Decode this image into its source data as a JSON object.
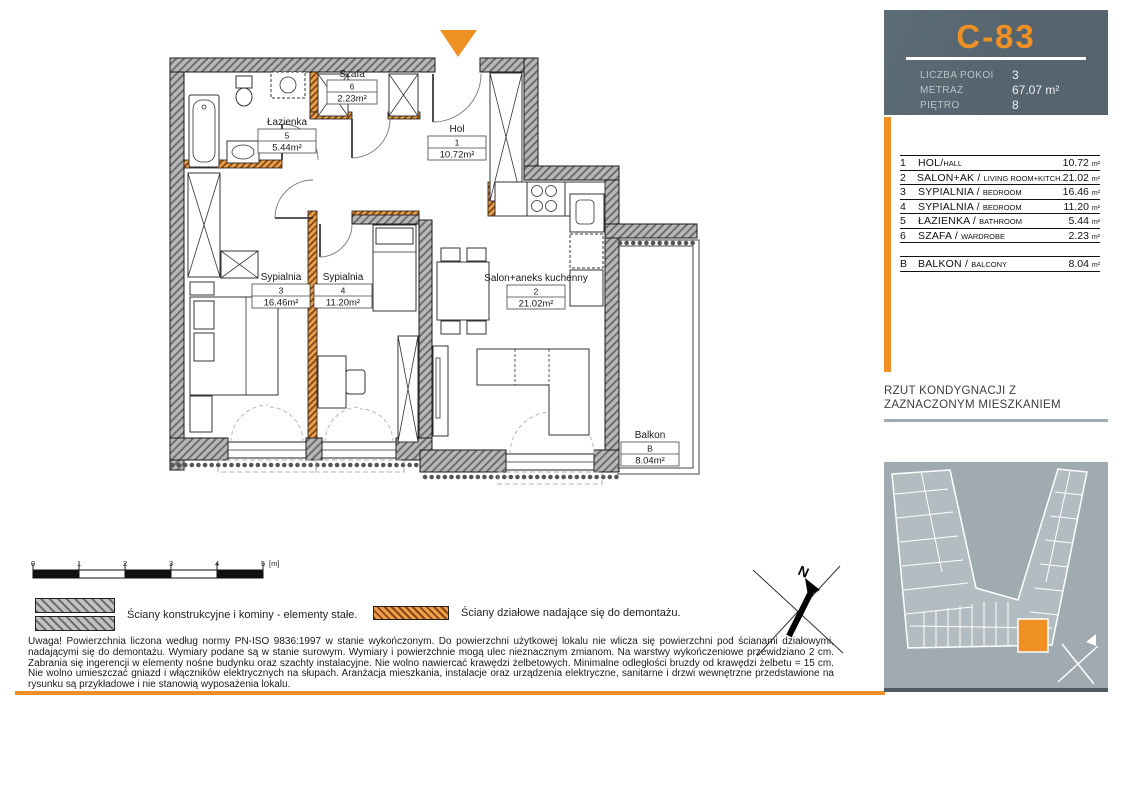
{
  "colors": {
    "accent": "#EE9023",
    "header_bg": "#55646E",
    "map_bg": "#9FAAB1",
    "map_building": "#B3BCC1",
    "map_border": "#4E5B63"
  },
  "unit_card": {
    "code": "C-83",
    "fields": [
      {
        "label": "LICZBA POKOI",
        "value": "3"
      },
      {
        "label": "METRAŻ",
        "value": "67.07 m²"
      },
      {
        "label": "PIĘTRO",
        "value": "8"
      }
    ]
  },
  "rooms_table": {
    "separator": "/",
    "area_unit": "m²",
    "rows": [
      {
        "no": "1",
        "name_pl": "HOL",
        "name_en": "HALL",
        "area": "10.72"
      },
      {
        "no": "2",
        "name_pl": "SALON+AK",
        "name_en": "LIVING ROOM+KITCH.",
        "area": "21.02"
      },
      {
        "no": "3",
        "name_pl": "SYPIALNIA",
        "name_en": "BEDROOM",
        "area": "16.46"
      },
      {
        "no": "4",
        "name_pl": "SYPIALNIA",
        "name_en": "BEDROOM",
        "area": "11.20"
      },
      {
        "no": "5",
        "name_pl": "ŁAZIENKA",
        "name_en": "BATHROOM",
        "area": "5.44"
      },
      {
        "no": "6",
        "name_pl": "SZAFA",
        "name_en": "WARDROBE",
        "area": "2.23"
      }
    ],
    "balcony": {
      "no": "B",
      "name_pl": "BALKON",
      "name_en": "BALCONY",
      "area": "8.04"
    }
  },
  "plan": {
    "labels": [
      {
        "name": "Łazienka",
        "no": "5",
        "area": "5.44m²"
      },
      {
        "name": "Szafa",
        "no": "6",
        "area": "2.23m²"
      },
      {
        "name": "Hol",
        "no": "1",
        "area": "10.72m²"
      },
      {
        "name": "Sypialnia",
        "no": "3",
        "area": "16.46m²"
      },
      {
        "name": "Sypialnia",
        "no": "4",
        "area": "11.20m²"
      },
      {
        "name": "Salon+aneks kuchenny",
        "no": "2",
        "area": "21.02m²"
      },
      {
        "name": "Balkon",
        "no": "B",
        "area": "8.04m²"
      }
    ]
  },
  "caption": "RZUT KONDYGNACJI Z ZAZNACZONYM MIESZKANIEM",
  "scale_bar": {
    "ticks": [
      "0",
      "1",
      "2",
      "3",
      "4",
      "5"
    ],
    "unit_suffix": "[m]"
  },
  "legend": [
    {
      "text": "Ściany konstrukcyjne i kominy - elementy stałe."
    },
    {
      "text": "Ściany działowe nadające się do demontażu."
    }
  ],
  "compass": {
    "north_label": "N"
  },
  "disclaimer": "Uwaga! Powierzchnia liczona według normy PN-ISO 9836:1997 w stanie wykończonym. Do powierzchni użytkowej lokalu nie wlicza się powierzchni pod ścianami działowymi, nadającymi się do demontażu.  Wymiary podane są w stanie surowym. Wymiary i powierzchnie mogą ulec nieznacznym zmianom. Na warstwy wykończeniowe przewidziano 2 cm. Zabrania się ingerencji w elementy nośne budynku oraz szachty instalacyjne.  Nie wolno nawiercać krawędzi żelbetowych. Minimalne odległości bruzdy od krawędzi żelbetu = 15 cm. Nie wolno umieszczać gniazd i włączników elektrycznych na słupach. Aranżacja mieszkania, instalacje oraz urządzenia elektryczne, sanitarne i drzwi wewnętrzne przedstawione na rysunku są przykładowe i nie stanowią wyposażenia lokalu."
}
